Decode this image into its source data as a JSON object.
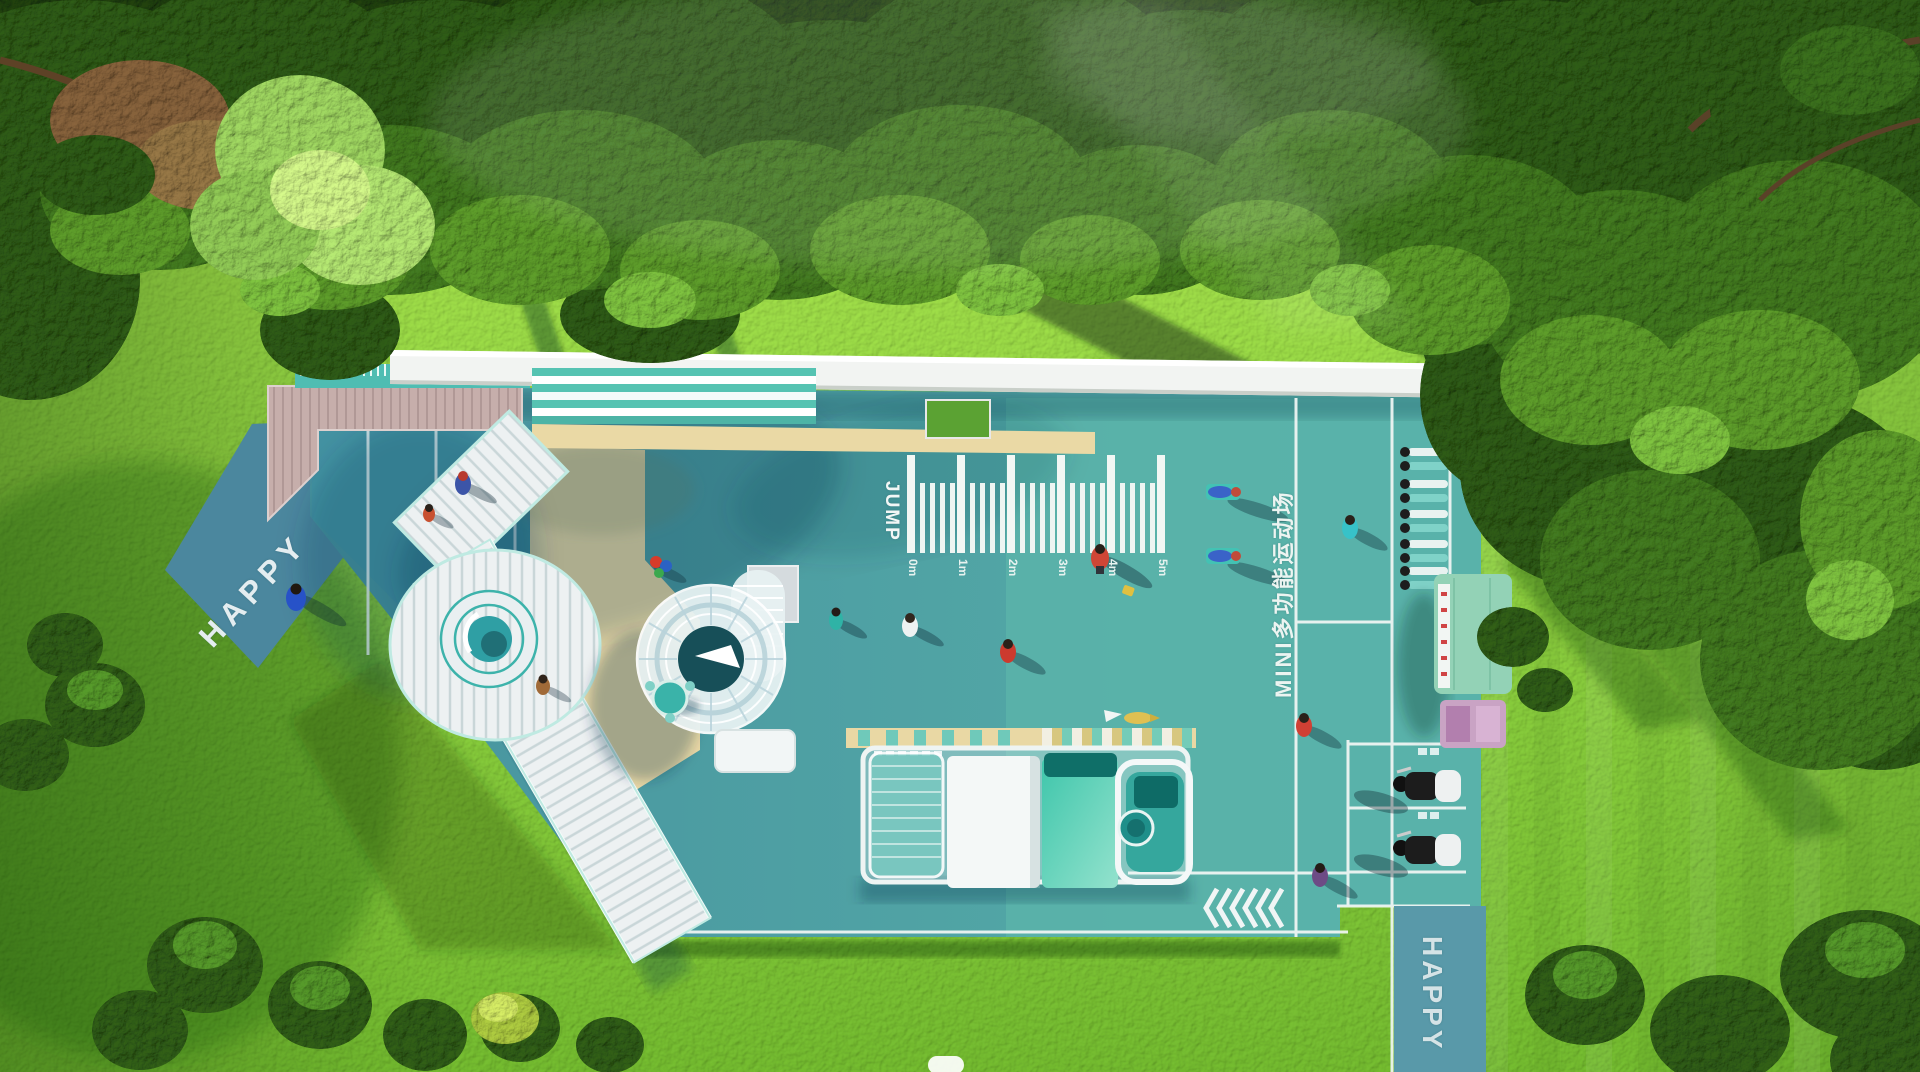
{
  "scene": {
    "type": "3d-aerial-render",
    "subject": "Top-down render of a children's playground and MINI multifunction sports court set in a lawn surrounded by trees"
  },
  "labels": {
    "happy_path_left": "HAPPY",
    "happy_path_bottom": "HAPPY",
    "jump_zone": "JUMP",
    "court_name": "MINI多功能运动场",
    "jump_marks": [
      "0m",
      "1m",
      "2m",
      "3m",
      "4m",
      "5m"
    ]
  },
  "features": [
    "wooden deck",
    "striped canopy benches",
    "spiral tube slide",
    "elevated loop walkway with ring",
    "train play structure",
    "jump distance ruler",
    "fitness stations",
    "exercise bikes",
    "vending kiosk",
    "chevron path markings",
    "round picnic table"
  ],
  "palette": {
    "court_teal": "#4d9fa4",
    "court_teal_light": "#5ab3aa",
    "court_blue": "#4392a2",
    "path_blue": "#5492a8",
    "sand": "#ead9a5",
    "deck_wood": "#c6aeab",
    "roof_white": "#f2f4f2",
    "stripe_teal": "#52c2b2",
    "train_teal": "#3fc6ab",
    "kiosk_green": "#93d2b6",
    "grass_light": "#9ecf46",
    "grass_dark": "#68a92a",
    "tree_dark": "#2a5313",
    "line_white": "#ffffff"
  }
}
